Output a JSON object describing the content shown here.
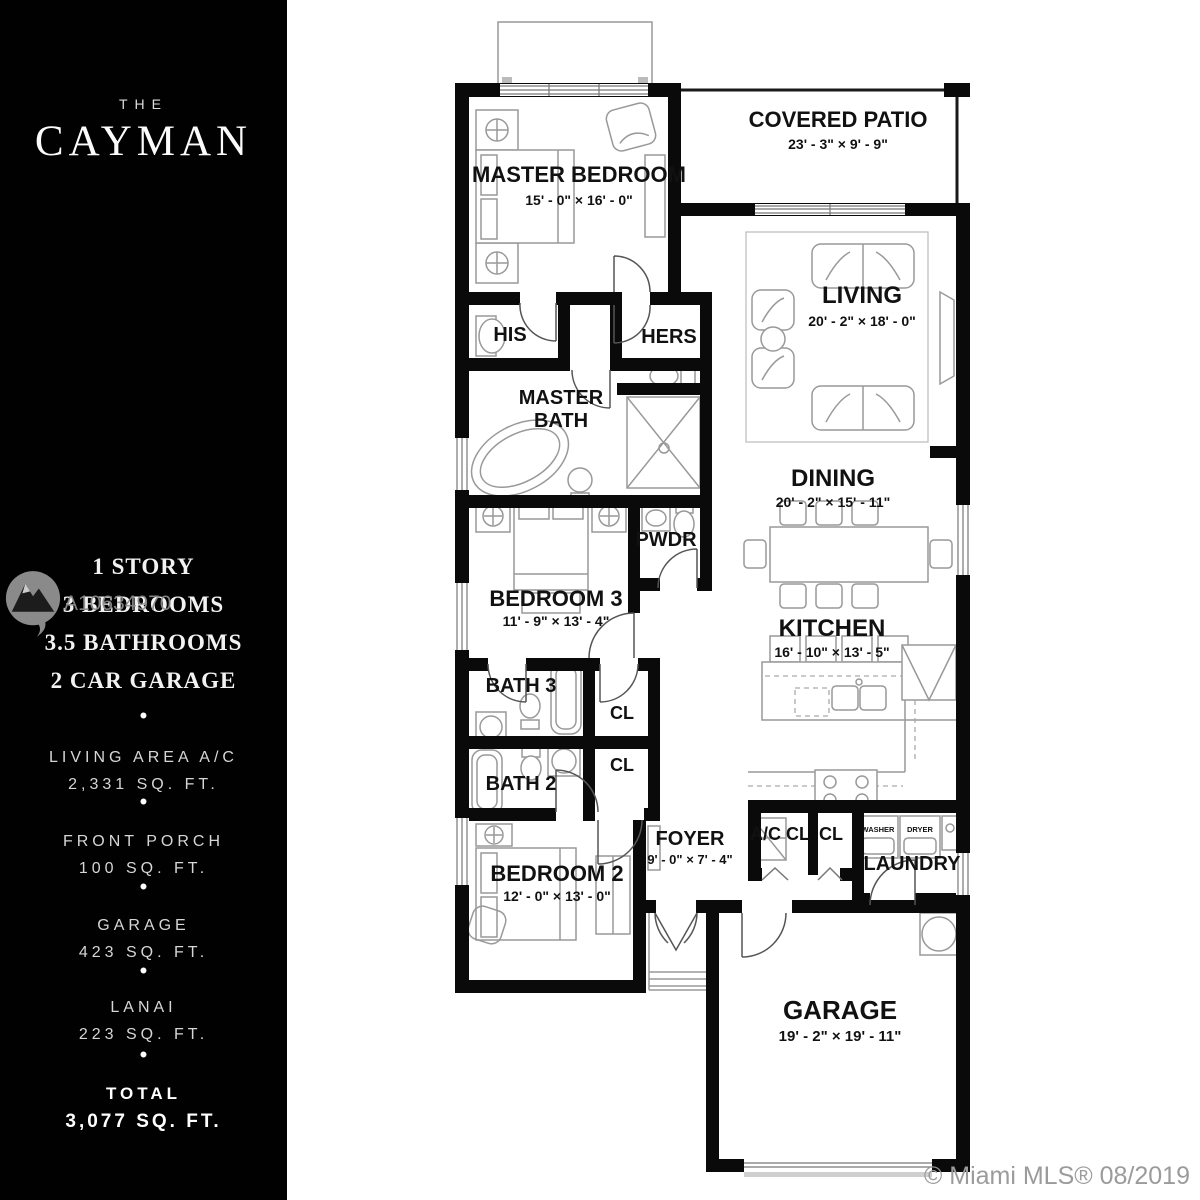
{
  "colors": {
    "sidebar_bg": "#010101",
    "wall": "#0a0a0a",
    "plan_text": "#111111",
    "watermark_gray": "#8d8d8d",
    "footer_gray": "#9b9b9b"
  },
  "sidebar": {
    "brand_pre": "THE",
    "brand_name": "CAYMAN",
    "bullet": "•",
    "features": [
      "1 STORY",
      "3 BEDROOMS",
      "3.5 BATHROOMS",
      "2 CAR GARAGE"
    ],
    "stats": [
      {
        "label": "LIVING AREA A/C",
        "value": "2,331 SQ. FT."
      },
      {
        "label": "FRONT PORCH",
        "value": "100 SQ. FT."
      },
      {
        "label": "GARAGE",
        "value": "423 SQ. FT."
      },
      {
        "label": "LANAI",
        "value": "223 SQ. FT."
      }
    ],
    "total": {
      "label": "TOTAL",
      "value": "3,077 SQ. FT."
    }
  },
  "watermark": {
    "id": "A10634970"
  },
  "footer": {
    "attribution": "© Miami MLS® 08/2019"
  },
  "plan": {
    "rooms": {
      "master_bedroom": {
        "name": "MASTER BEDROOM",
        "dims": "15' - 0\" × 16' - 0\""
      },
      "covered_patio": {
        "name": "COVERED PATIO",
        "dims": "23' - 3\" × 9' - 9\""
      },
      "living": {
        "name": "LIVING",
        "dims": "20' - 2\" × 18' - 0\""
      },
      "dining": {
        "name": "DINING",
        "dims": "20' - 2\" × 15' - 11\""
      },
      "kitchen": {
        "name": "KITCHEN",
        "dims": "16' - 10\" × 13' - 5\""
      },
      "bedroom_3": {
        "name": "BEDROOM 3",
        "dims": "11' - 9\" × 13' - 4\""
      },
      "bedroom_2": {
        "name": "BEDROOM 2",
        "dims": "12' - 0\" × 13' - 0\""
      },
      "foyer": {
        "name": "FOYER",
        "dims": "9' - 0\" × 7' - 4\""
      },
      "garage": {
        "name": "GARAGE",
        "dims": "19' - 2\" × 19' - 11\""
      }
    },
    "labels": {
      "his": "HIS",
      "hers": "HERS",
      "master_bath_line1": "MASTER",
      "master_bath_line2": "BATH",
      "pwdr": "PWDR",
      "bath_3": "BATH 3",
      "bath_2": "BATH 2",
      "cl": "CL",
      "ac_cl": "A/C CL",
      "laundry": "LAUNDRY",
      "washer": "WASHER",
      "dryer": "DRYER"
    }
  }
}
